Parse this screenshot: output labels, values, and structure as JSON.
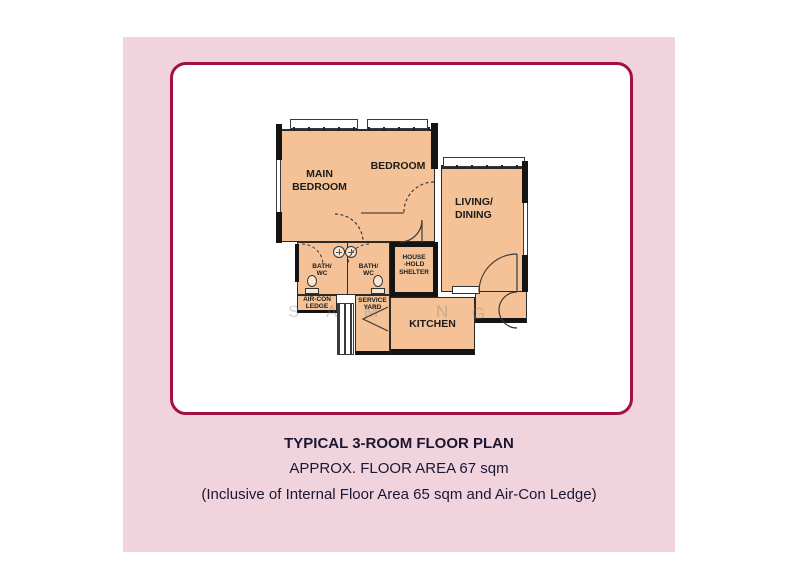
{
  "colors": {
    "panel_pink": "#f1d3de",
    "card_border_maroon": "#a31043",
    "plan_fill_peach": "#f4c296",
    "wall_black": "#141414",
    "caption_text": "#1b1733"
  },
  "captions": {
    "title": "TYPICAL 3-ROOM FLOOR PLAN",
    "area": "APPROX. FLOOR AREA 67 sqm",
    "note": "(Inclusive of Internal Floor Area 65 sqm and Air-Con Ledge)"
  },
  "plan": {
    "rooms": {
      "main_bedroom": {
        "line1": "MAIN",
        "line2": "BEDROOM"
      },
      "bedroom": {
        "label": "BEDROOM"
      },
      "living_dining": {
        "line1": "LIVING/",
        "line2": "DINING"
      },
      "kitchen": {
        "label": "KITCHEN"
      },
      "bath1": {
        "line1": "BATH/",
        "line2": "WC"
      },
      "bath2": {
        "line1": "BATH/",
        "line2": "WC"
      },
      "household_shelter": {
        "line1": "HOUSE",
        "line2": "-HOLD",
        "line3": "SHELTER"
      },
      "aircon_ledge": {
        "line1": "AIR-CON",
        "line2": "LEDGE"
      },
      "service_yard": {
        "line1": "SERVICE",
        "line2": "YARD"
      }
    },
    "watermark": [
      "S",
      "A",
      "M",
      "N",
      "G"
    ]
  }
}
